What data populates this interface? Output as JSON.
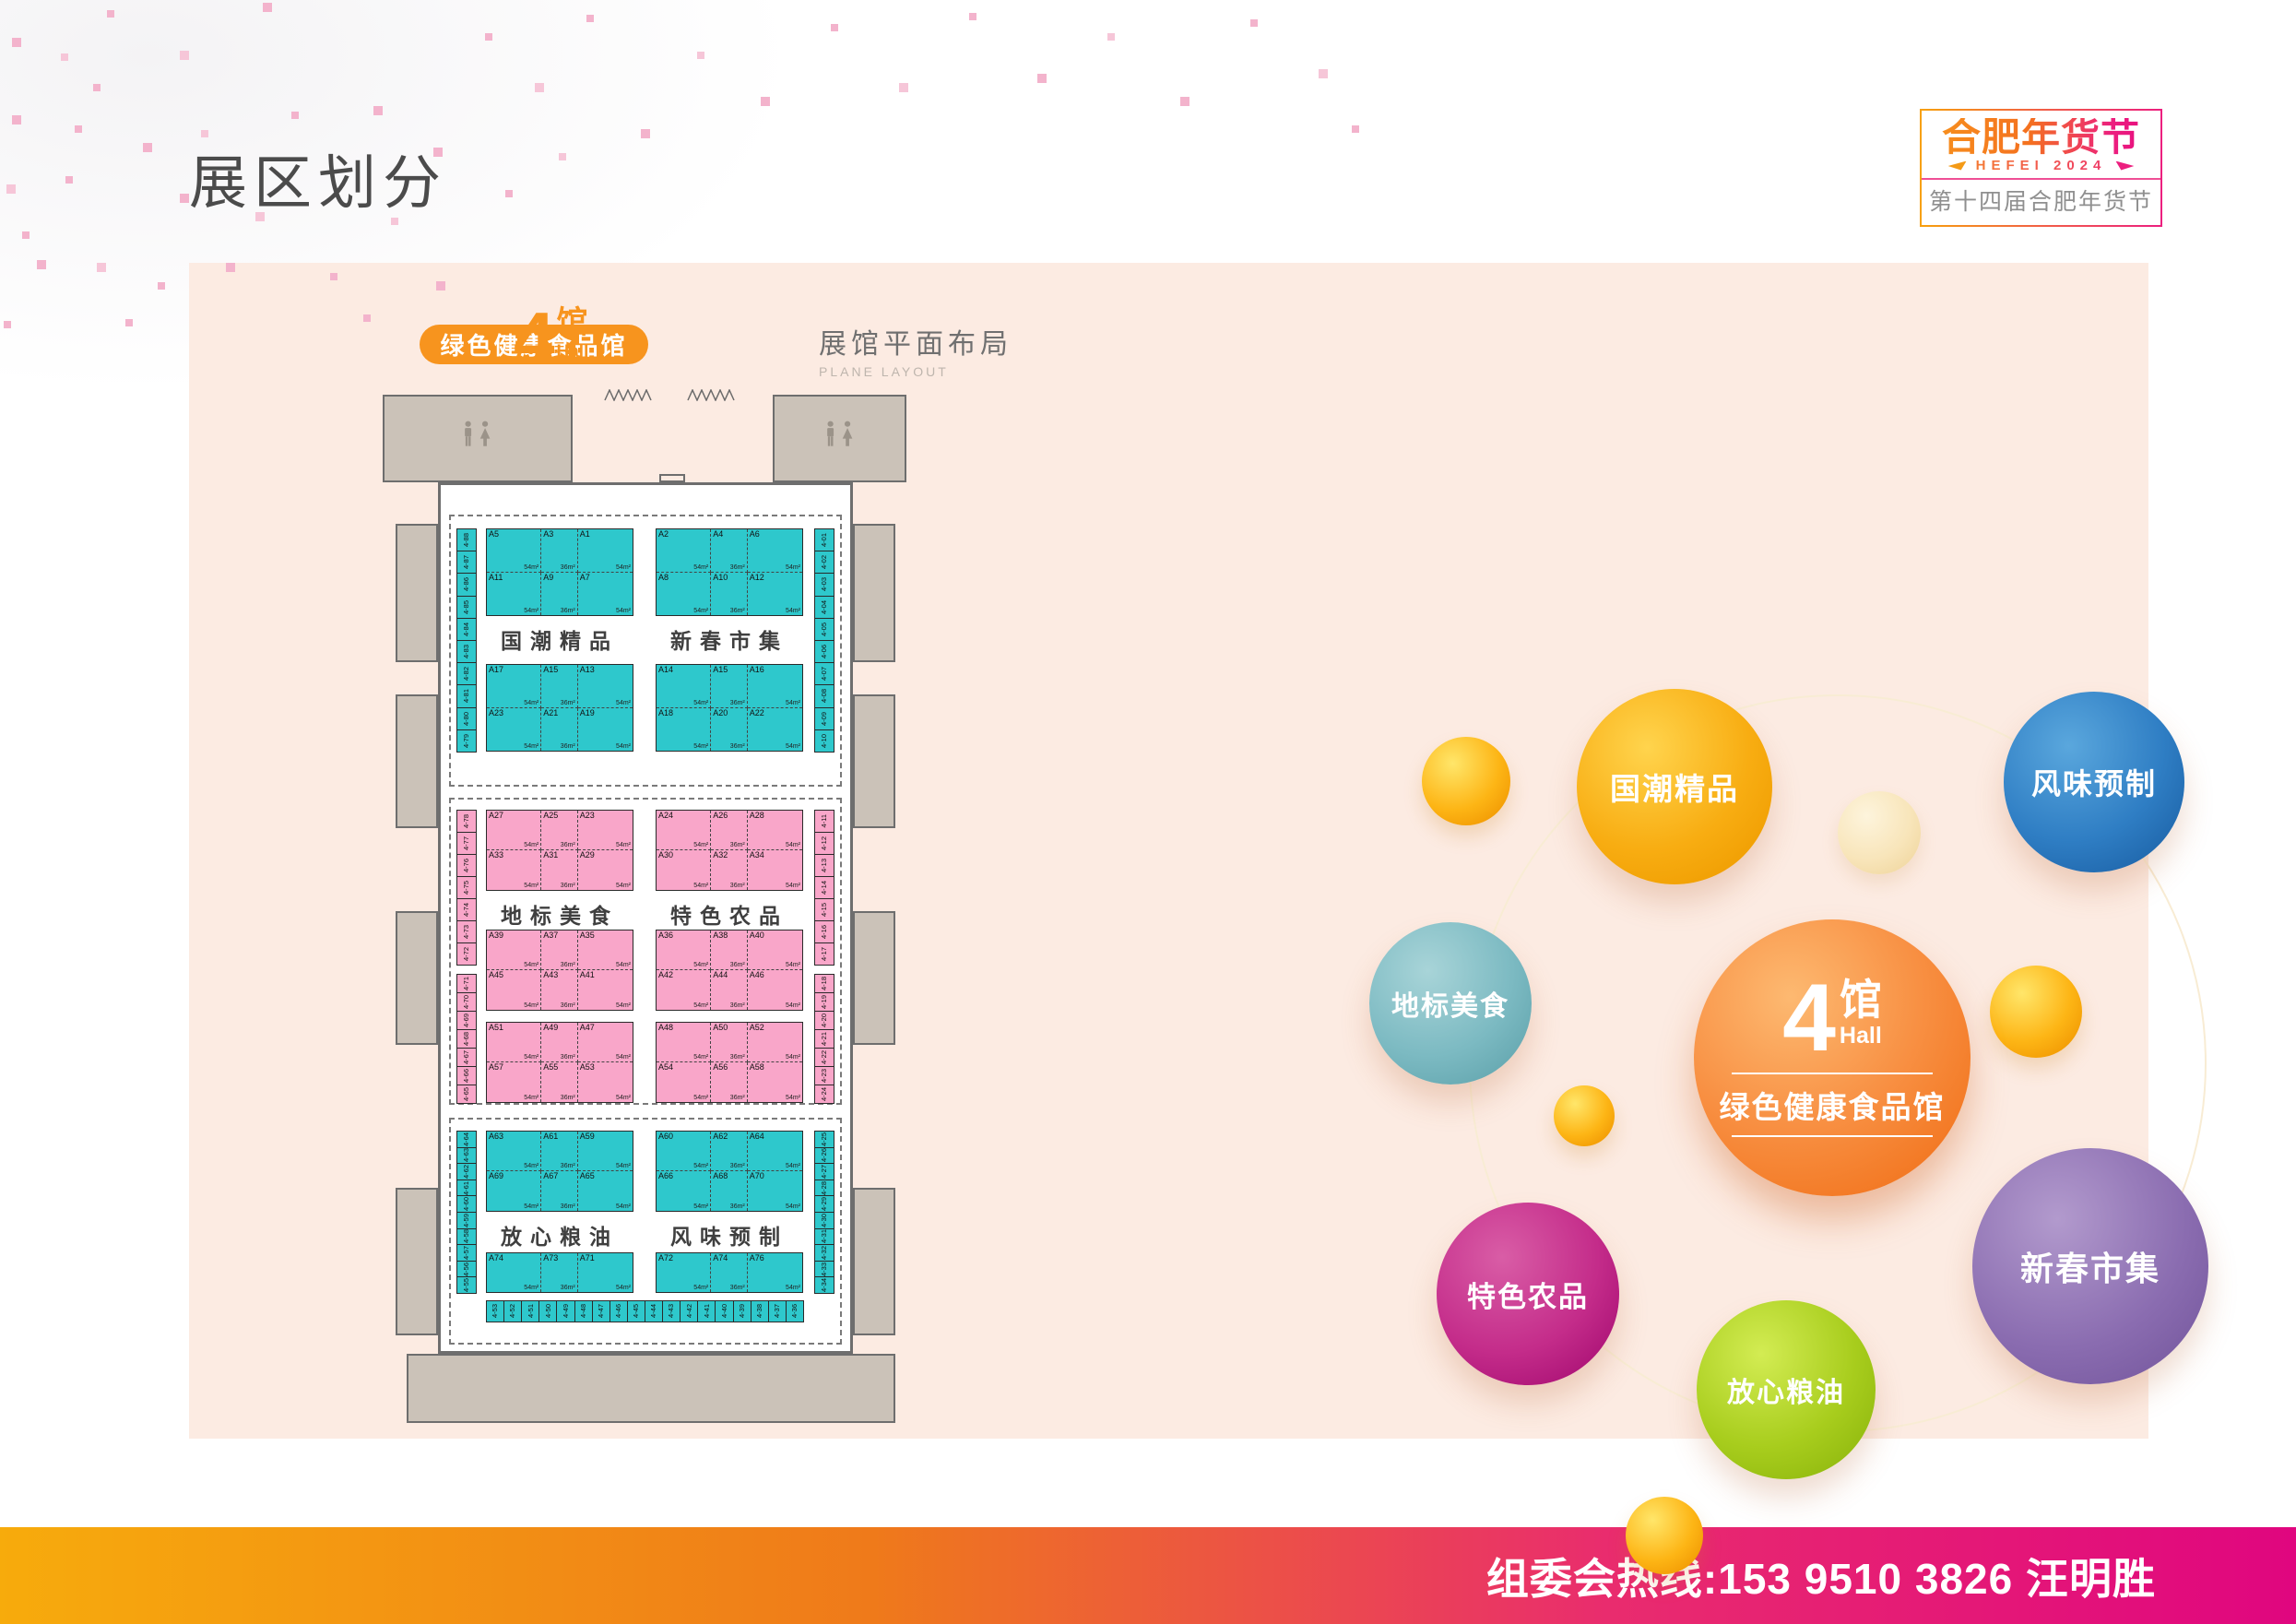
{
  "header": {
    "title": "展区划分"
  },
  "logo": {
    "title": "合肥年货节",
    "year": "HEFEI 2024",
    "subtitle": "第十四届合肥年货节"
  },
  "hall": {
    "number": "4",
    "unit": "馆",
    "hall_en": "Hall",
    "name": "绿色健康食品馆"
  },
  "plan": {
    "title": "展馆平面布局",
    "subtitle": "PLANE LAYOUT",
    "areas": [
      "54m²",
      "36m²",
      "54m²"
    ],
    "sections": [
      {
        "color": "teal",
        "zone_left": "国潮精品",
        "zone_right": "新春市集",
        "blocks": [
          {
            "left": [
              "A5",
              "A3",
              "A1",
              "A11",
              "A9",
              "A7"
            ],
            "right": [
              "A2",
              "A4",
              "A6",
              "A8",
              "A10",
              "A12"
            ]
          },
          {
            "left": [
              "A17",
              "A15",
              "A13",
              "A23",
              "A21",
              "A19"
            ],
            "right": [
              "A14",
              "A15",
              "A16",
              "A18",
              "A20",
              "A22"
            ]
          }
        ],
        "side_left": [
          "4-88",
          "4-87",
          "4-86",
          "4-85",
          "4-84",
          "4-83",
          "4-82",
          "4-81",
          "4-80",
          "4-79"
        ],
        "side_right": [
          "4-01",
          "4-02",
          "4-03",
          "4-04",
          "4-05",
          "4-06",
          "4-07",
          "4-08",
          "4-09",
          "4-10"
        ]
      },
      {
        "color": "pink",
        "zone_left": "地标美食",
        "zone_right": "特色农品",
        "blocks": [
          {
            "left": [
              "A27",
              "A25",
              "A23",
              "A33",
              "A31",
              "A29"
            ],
            "right": [
              "A24",
              "A26",
              "A28",
              "A30",
              "A32",
              "A34"
            ]
          },
          {
            "left": [
              "A39",
              "A37",
              "A35",
              "A45",
              "A43",
              "A41"
            ],
            "right": [
              "A36",
              "A38",
              "A40",
              "A42",
              "A44",
              "A46"
            ]
          },
          {
            "left": [
              "A51",
              "A49",
              "A47",
              "A57",
              "A55",
              "A53"
            ],
            "right": [
              "A48",
              "A50",
              "A52",
              "A54",
              "A56",
              "A58"
            ]
          }
        ],
        "side_left": [
          "4-78",
          "4-77",
          "4-76",
          "4-75",
          "4-74",
          "4-73",
          "4-72",
          "4-71",
          "4-70",
          "4-69",
          "4-68",
          "4-67",
          "4-66",
          "4-65"
        ],
        "side_right": [
          "4-11",
          "4-12",
          "4-13",
          "4-14",
          "4-15",
          "4-16",
          "4-17",
          "4-18",
          "4-19",
          "4-20",
          "4-21",
          "4-22",
          "4-23",
          "4-24"
        ]
      },
      {
        "color": "teal",
        "zone_left": "放心粮油",
        "zone_right": "风味预制",
        "blocks": [
          {
            "left": [
              "A63",
              "A61",
              "A59",
              "A69",
              "A67",
              "A65"
            ],
            "right": [
              "A60",
              "A62",
              "A64",
              "A66",
              "A68",
              "A70"
            ]
          },
          {
            "left": [
              "A74",
              "A73",
              "A71"
            ],
            "right": [
              "A72",
              "A74",
              "A76"
            ]
          }
        ],
        "side_left": [
          "4-64",
          "4-63",
          "4-62",
          "4-61",
          "4-60",
          "4-59",
          "4-58",
          "4-57",
          "4-56",
          "4-55"
        ],
        "side_right": [
          "4-25",
          "4-26",
          "4-27",
          "4-28",
          "4-29",
          "4-30",
          "4-31",
          "4-32",
          "4-33",
          "4-34"
        ],
        "bottom": [
          "4-53",
          "4-52",
          "4-51",
          "4-50",
          "4-49",
          "4-48",
          "4-47",
          "4-46",
          "4-45",
          "4-44",
          "4-43",
          "4-42",
          "4-41",
          "4-40",
          "4-39",
          "4-38",
          "4-37",
          "4-36"
        ]
      }
    ]
  },
  "bubbles": {
    "center": {
      "number": "4",
      "unit": "馆",
      "hall_en": "Hall",
      "name": "绿色健康食品馆",
      "color": "#f58332"
    },
    "satellites": [
      {
        "key": "guochao",
        "label": "国潮精品",
        "color": "#f8ad12"
      },
      {
        "key": "fengwei",
        "label": "风味预制",
        "color": "#2f7ec4"
      },
      {
        "key": "dibiao",
        "label": "地标美食",
        "color": "#7cbac2"
      },
      {
        "key": "texe",
        "label": "特色农品",
        "color": "#c42c8a"
      },
      {
        "key": "fangxin",
        "label": "放心粮油",
        "color": "#a8cd1d"
      },
      {
        "key": "xinchun",
        "label": "新春市集",
        "color": "#8a6cb0"
      }
    ]
  },
  "footer": {
    "hotline": "组委会热线:153 9510 3826 汪明胜"
  },
  "colors": {
    "panel_bg": "#fcebe2",
    "booth_teal": "#2ec8cc",
    "booth_pink": "#f9a6c9",
    "building_gray": "#cbc2b8",
    "accent_orange": "#f7941e",
    "footer_gradient_start": "#f7ab0c",
    "footer_gradient_end": "#e0067f",
    "logo_pink": "#ec1f7f",
    "title_gray": "#4b4b4b"
  }
}
